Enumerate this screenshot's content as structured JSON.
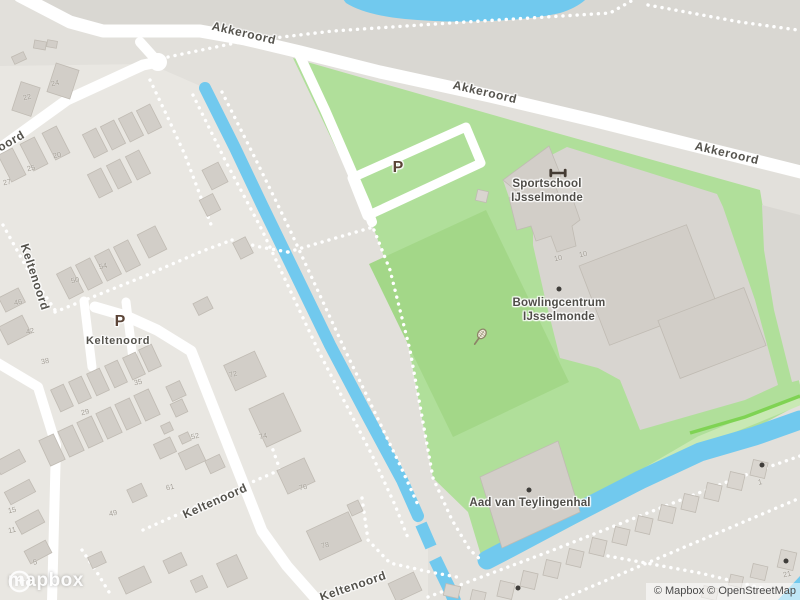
{
  "map": {
    "street_labels": [
      {
        "text": "Akkeroord",
        "x": 244,
        "y": 33,
        "rot": 13,
        "size": 12
      },
      {
        "text": "Akkeroord",
        "x": 485,
        "y": 92,
        "rot": 13,
        "size": 12
      },
      {
        "text": "Akkeroord",
        "x": 727,
        "y": 153,
        "rot": 13,
        "size": 12
      },
      {
        "text": "oord",
        "x": 11,
        "y": 141,
        "rot": -30,
        "size": 12
      },
      {
        "text": "Keltenoord",
        "x": 35,
        "y": 277,
        "rot": 72,
        "size": 12
      },
      {
        "text": "Keltenoord",
        "x": 215,
        "y": 501,
        "rot": -24,
        "size": 12
      },
      {
        "text": "Keltenoord",
        "x": 353,
        "y": 586,
        "rot": -19,
        "size": 12
      },
      {
        "text": "Keltenoord",
        "x": 118,
        "y": 341,
        "rot": 0,
        "size": 11
      }
    ],
    "poi_labels": [
      {
        "lines": [
          "Sportschool",
          "IJsselmonde"
        ],
        "x": 547,
        "y": 191
      },
      {
        "lines": [
          "Bowlingcentrum",
          "IJsselmonde"
        ],
        "x": 559,
        "y": 310
      },
      {
        "lines": [
          "Aad van Teylingenhal"
        ],
        "x": 530,
        "y": 503
      }
    ],
    "parking_markers": [
      {
        "text": "P",
        "x": 398,
        "y": 168
      },
      {
        "text": "P",
        "x": 120,
        "y": 322
      }
    ],
    "house_numbers": [
      {
        "text": "22",
        "x": 27,
        "y": 97
      },
      {
        "text": "24",
        "x": 55,
        "y": 83
      },
      {
        "text": "27",
        "x": 7,
        "y": 182
      },
      {
        "text": "25",
        "x": 31,
        "y": 168
      },
      {
        "text": "20",
        "x": 57,
        "y": 155
      },
      {
        "text": "54",
        "x": 103,
        "y": 266
      },
      {
        "text": "50",
        "x": 75,
        "y": 280
      },
      {
        "text": "46",
        "x": 18,
        "y": 302
      },
      {
        "text": "42",
        "x": 30,
        "y": 331
      },
      {
        "text": "38",
        "x": 45,
        "y": 361
      },
      {
        "text": "29",
        "x": 85,
        "y": 412
      },
      {
        "text": "35",
        "x": 138,
        "y": 382
      },
      {
        "text": "15",
        "x": 12,
        "y": 510
      },
      {
        "text": "11",
        "x": 12,
        "y": 530
      },
      {
        "text": "5",
        "x": 35,
        "y": 562
      },
      {
        "text": "49",
        "x": 113,
        "y": 513
      },
      {
        "text": "61",
        "x": 170,
        "y": 487
      },
      {
        "text": "52",
        "x": 195,
        "y": 436
      },
      {
        "text": "72",
        "x": 233,
        "y": 374
      },
      {
        "text": "74",
        "x": 263,
        "y": 436
      },
      {
        "text": "76",
        "x": 303,
        "y": 487
      },
      {
        "text": "78",
        "x": 325,
        "y": 545
      },
      {
        "text": "10",
        "x": 558,
        "y": 258
      },
      {
        "text": "10",
        "x": 583,
        "y": 254
      },
      {
        "text": "1",
        "x": 760,
        "y": 482
      },
      {
        "text": "21",
        "x": 787,
        "y": 574
      }
    ],
    "icons": [
      {
        "name": "fitness-icon",
        "x": 548,
        "y": 166
      },
      {
        "name": "tennis-icon",
        "x": 468,
        "y": 325
      }
    ],
    "poi_dots": [
      {
        "x": 559,
        "y": 289
      },
      {
        "x": 529,
        "y": 490
      },
      {
        "x": 762,
        "y": 465
      },
      {
        "x": 786,
        "y": 561
      },
      {
        "x": 518,
        "y": 588
      }
    ]
  },
  "colors": {
    "water": "#71c9ee",
    "green": "#b0df9a",
    "field": "#a3d788",
    "band_light": "#c9e9b4",
    "band_bright": "#7fd353",
    "road": "#ffffff",
    "building": "#d2cec8",
    "building_stroke": "#c0bbb3",
    "shed": "#d9d5cf",
    "plot": "#d8d5d0",
    "base": "#e2e0db",
    "north": "#d9d7d2",
    "residential": "#e9e7e2"
  },
  "logo": {
    "text": "mapbox"
  },
  "attribution": {
    "text": "© Mapbox © OpenStreetMap"
  }
}
